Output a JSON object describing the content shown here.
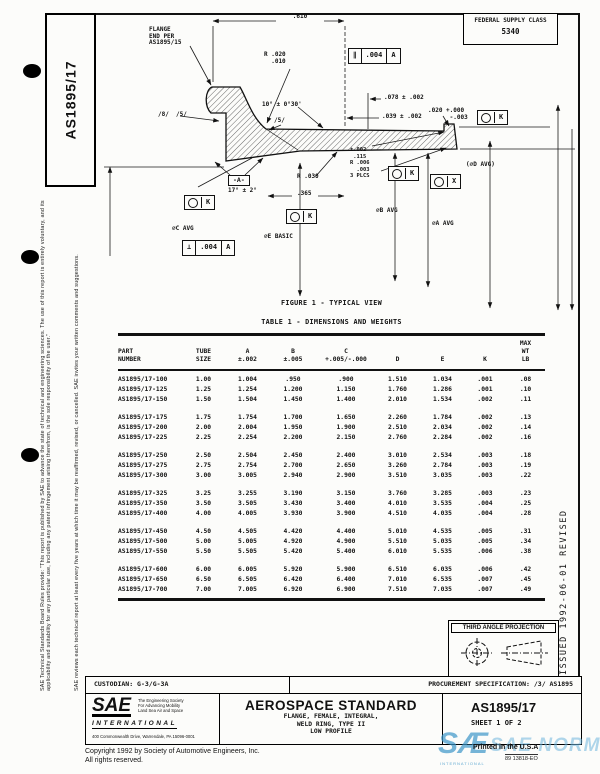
{
  "doc": {
    "tab": "AS1895/17",
    "federal_supply_class": {
      "label": "FEDERAL SUPPLY CLASS",
      "value": "5340"
    },
    "issued_strip": "ISSUED  1992-06-01  REVISED",
    "left_notices": [
      "SAE Technical Standards Board Rules provide: \"This report is published by SAE to advance the state of technical and engineering sciences. The use of this report is entirely voluntary, and its applicability and suitability for any particular use, including any patent infringement arising therefrom, is the sole responsibility of the user.\"",
      "SAE reviews each technical report at least every five years at which time it may be reaffirmed, revised, or cancelled. SAE invites your written comments and suggestions."
    ]
  },
  "figure": {
    "caption": "FIGURE 1 - TYPICAL VIEW",
    "texts": [
      {
        "t": ".610",
        "x": 300,
        "y": 14,
        "a": "c"
      },
      {
        "t": "FLANGE\nEND PER\nAS1895/15",
        "x": 149,
        "y": 27
      },
      {
        "t": "R .020\n  .010",
        "x": 264,
        "y": 52
      },
      {
        "t": "10° ± 0°30'",
        "x": 262,
        "y": 102
      },
      {
        "t": ".078 ± .002",
        "x": 384,
        "y": 95
      },
      {
        "t": ".039 ± .002",
        "x": 382,
        "y": 114
      },
      {
        "t": ".020 +.000\n      -.003",
        "x": 428,
        "y": 108
      },
      {
        "t": "(⌀D AVG)",
        "x": 466,
        "y": 162
      },
      {
        "t": "±.002\n .115\nR .006\n  .003\n3 PLCS",
        "x": 350,
        "y": 147,
        "s": 5.4
      },
      {
        "t": "/8/  /5/",
        "x": 158,
        "y": 112
      },
      {
        "t": "/5/",
        "x": 274,
        "y": 118
      },
      {
        "t": "17° ± 2°",
        "x": 228,
        "y": 188
      },
      {
        "t": "R .030",
        "x": 297,
        "y": 174
      },
      {
        "t": ".365",
        "x": 297,
        "y": 191
      },
      {
        "t": "⌀C AVG",
        "x": 172,
        "y": 226
      },
      {
        "t": "⌀E BASIC",
        "x": 264,
        "y": 234
      },
      {
        "t": "⌀B AVG",
        "x": 376,
        "y": 208
      },
      {
        "t": "⌀A AVG",
        "x": 432,
        "y": 221
      }
    ],
    "control_frames": [
      {
        "x": 348,
        "y": 48,
        "cells": [
          "∥",
          ".004",
          "A"
        ]
      },
      {
        "x": 182,
        "y": 240,
        "cells": [
          "⊥",
          ".004",
          "A"
        ]
      }
    ],
    "datum_targets": [
      {
        "x": 477,
        "y": 110,
        "letter": "K"
      },
      {
        "x": 388,
        "y": 166,
        "letter": "K"
      },
      {
        "x": 430,
        "y": 174,
        "letter": "X"
      },
      {
        "x": 184,
        "y": 195,
        "letter": "K"
      },
      {
        "x": 286,
        "y": 209,
        "letter": "K"
      }
    ],
    "datum_boxes": [
      {
        "x": 228,
        "y": 175,
        "label": "-A-"
      }
    ]
  },
  "table": {
    "title": "TABLE 1 - DIMENSIONS AND WEIGHTS",
    "headers": [
      "PART\nNUMBER",
      "TUBE\nSIZE",
      "A\n±.002",
      "B\n±.005",
      "C\n+.005/-.000",
      "D",
      "E",
      "K",
      "MAX\nWT\nLB"
    ],
    "rows": [
      [
        "AS1895/17-100",
        "1.00",
        "1.004",
        ".950",
        ".900",
        "1.510",
        "1.034",
        ".001",
        ".08"
      ],
      [
        "AS1895/17-125",
        "1.25",
        "1.254",
        "1.200",
        "1.150",
        "1.760",
        "1.286",
        ".001",
        ".10"
      ],
      [
        "AS1895/17-150",
        "1.50",
        "1.504",
        "1.450",
        "1.400",
        "2.010",
        "1.534",
        ".002",
        ".11"
      ],
      [
        "AS1895/17-175",
        "1.75",
        "1.754",
        "1.700",
        "1.650",
        "2.260",
        "1.784",
        ".002",
        ".13"
      ],
      [
        "AS1895/17-200",
        "2.00",
        "2.004",
        "1.950",
        "1.900",
        "2.510",
        "2.034",
        ".002",
        ".14"
      ],
      [
        "AS1895/17-225",
        "2.25",
        "2.254",
        "2.200",
        "2.150",
        "2.760",
        "2.284",
        ".002",
        ".16"
      ],
      [
        "AS1895/17-250",
        "2.50",
        "2.504",
        "2.450",
        "2.400",
        "3.010",
        "2.534",
        ".003",
        ".18"
      ],
      [
        "AS1895/17-275",
        "2.75",
        "2.754",
        "2.700",
        "2.650",
        "3.260",
        "2.784",
        ".003",
        ".19"
      ],
      [
        "AS1895/17-300",
        "3.00",
        "3.005",
        "2.940",
        "2.900",
        "3.510",
        "3.035",
        ".003",
        ".22"
      ],
      [
        "AS1895/17-325",
        "3.25",
        "3.255",
        "3.190",
        "3.150",
        "3.760",
        "3.285",
        ".003",
        ".23"
      ],
      [
        "AS1895/17-350",
        "3.50",
        "3.505",
        "3.430",
        "3.400",
        "4.010",
        "3.535",
        ".004",
        ".25"
      ],
      [
        "AS1895/17-400",
        "4.00",
        "4.005",
        "3.930",
        "3.900",
        "4.510",
        "4.035",
        ".004",
        ".28"
      ],
      [
        "AS1895/17-450",
        "4.50",
        "4.505",
        "4.420",
        "4.400",
        "5.010",
        "4.535",
        ".005",
        ".31"
      ],
      [
        "AS1895/17-500",
        "5.00",
        "5.005",
        "4.920",
        "4.900",
        "5.510",
        "5.035",
        ".005",
        ".34"
      ],
      [
        "AS1895/17-550",
        "5.50",
        "5.505",
        "5.420",
        "5.400",
        "6.010",
        "5.535",
        ".006",
        ".38"
      ],
      [
        "AS1895/17-600",
        "6.00",
        "6.005",
        "5.920",
        "5.900",
        "6.510",
        "6.035",
        ".006",
        ".42"
      ],
      [
        "AS1895/17-650",
        "6.50",
        "6.505",
        "6.420",
        "6.400",
        "7.010",
        "6.535",
        ".007",
        ".45"
      ],
      [
        "AS1895/17-700",
        "7.00",
        "7.005",
        "6.920",
        "6.900",
        "7.510",
        "7.035",
        ".007",
        ".49"
      ]
    ]
  },
  "projection": {
    "label": "THIRD ANGLE PROJECTION"
  },
  "custodian_row": {
    "custodian": "CUSTODIAN:  G-3/G-3A",
    "procurement": "PROCUREMENT SPECIFICATION:  /3/  AS1895"
  },
  "title_block": {
    "logo": "SAE",
    "society_lines": [
      "The Engineering Society",
      "For Advancing Mobility",
      "Land Sea Air and Space"
    ],
    "international": "INTERNATIONAL",
    "address": "400 Commonwealth Drive, Warrendale, PA 15096-0001",
    "doc_type": "AEROSPACE STANDARD",
    "subtitle_lines": [
      "FLANGE, FEMALE, INTEGRAL,",
      "WELD RING, TYPE II",
      "LOW PROFILE"
    ],
    "doc_number": "AS1895/17",
    "sheet": "SHEET 1 OF 2"
  },
  "footer": {
    "copyright": "Copyright  1992  by Society of Automotive Engineers, Inc.",
    "rights": "All rights reserved.",
    "printed": "Printed in the U.S.A",
    "code": "89 13818-EO",
    "watermark_main": "SÆ",
    "watermark_secondary": "SAE NORM",
    "watermark_sub": "INTERNATIONAL"
  }
}
